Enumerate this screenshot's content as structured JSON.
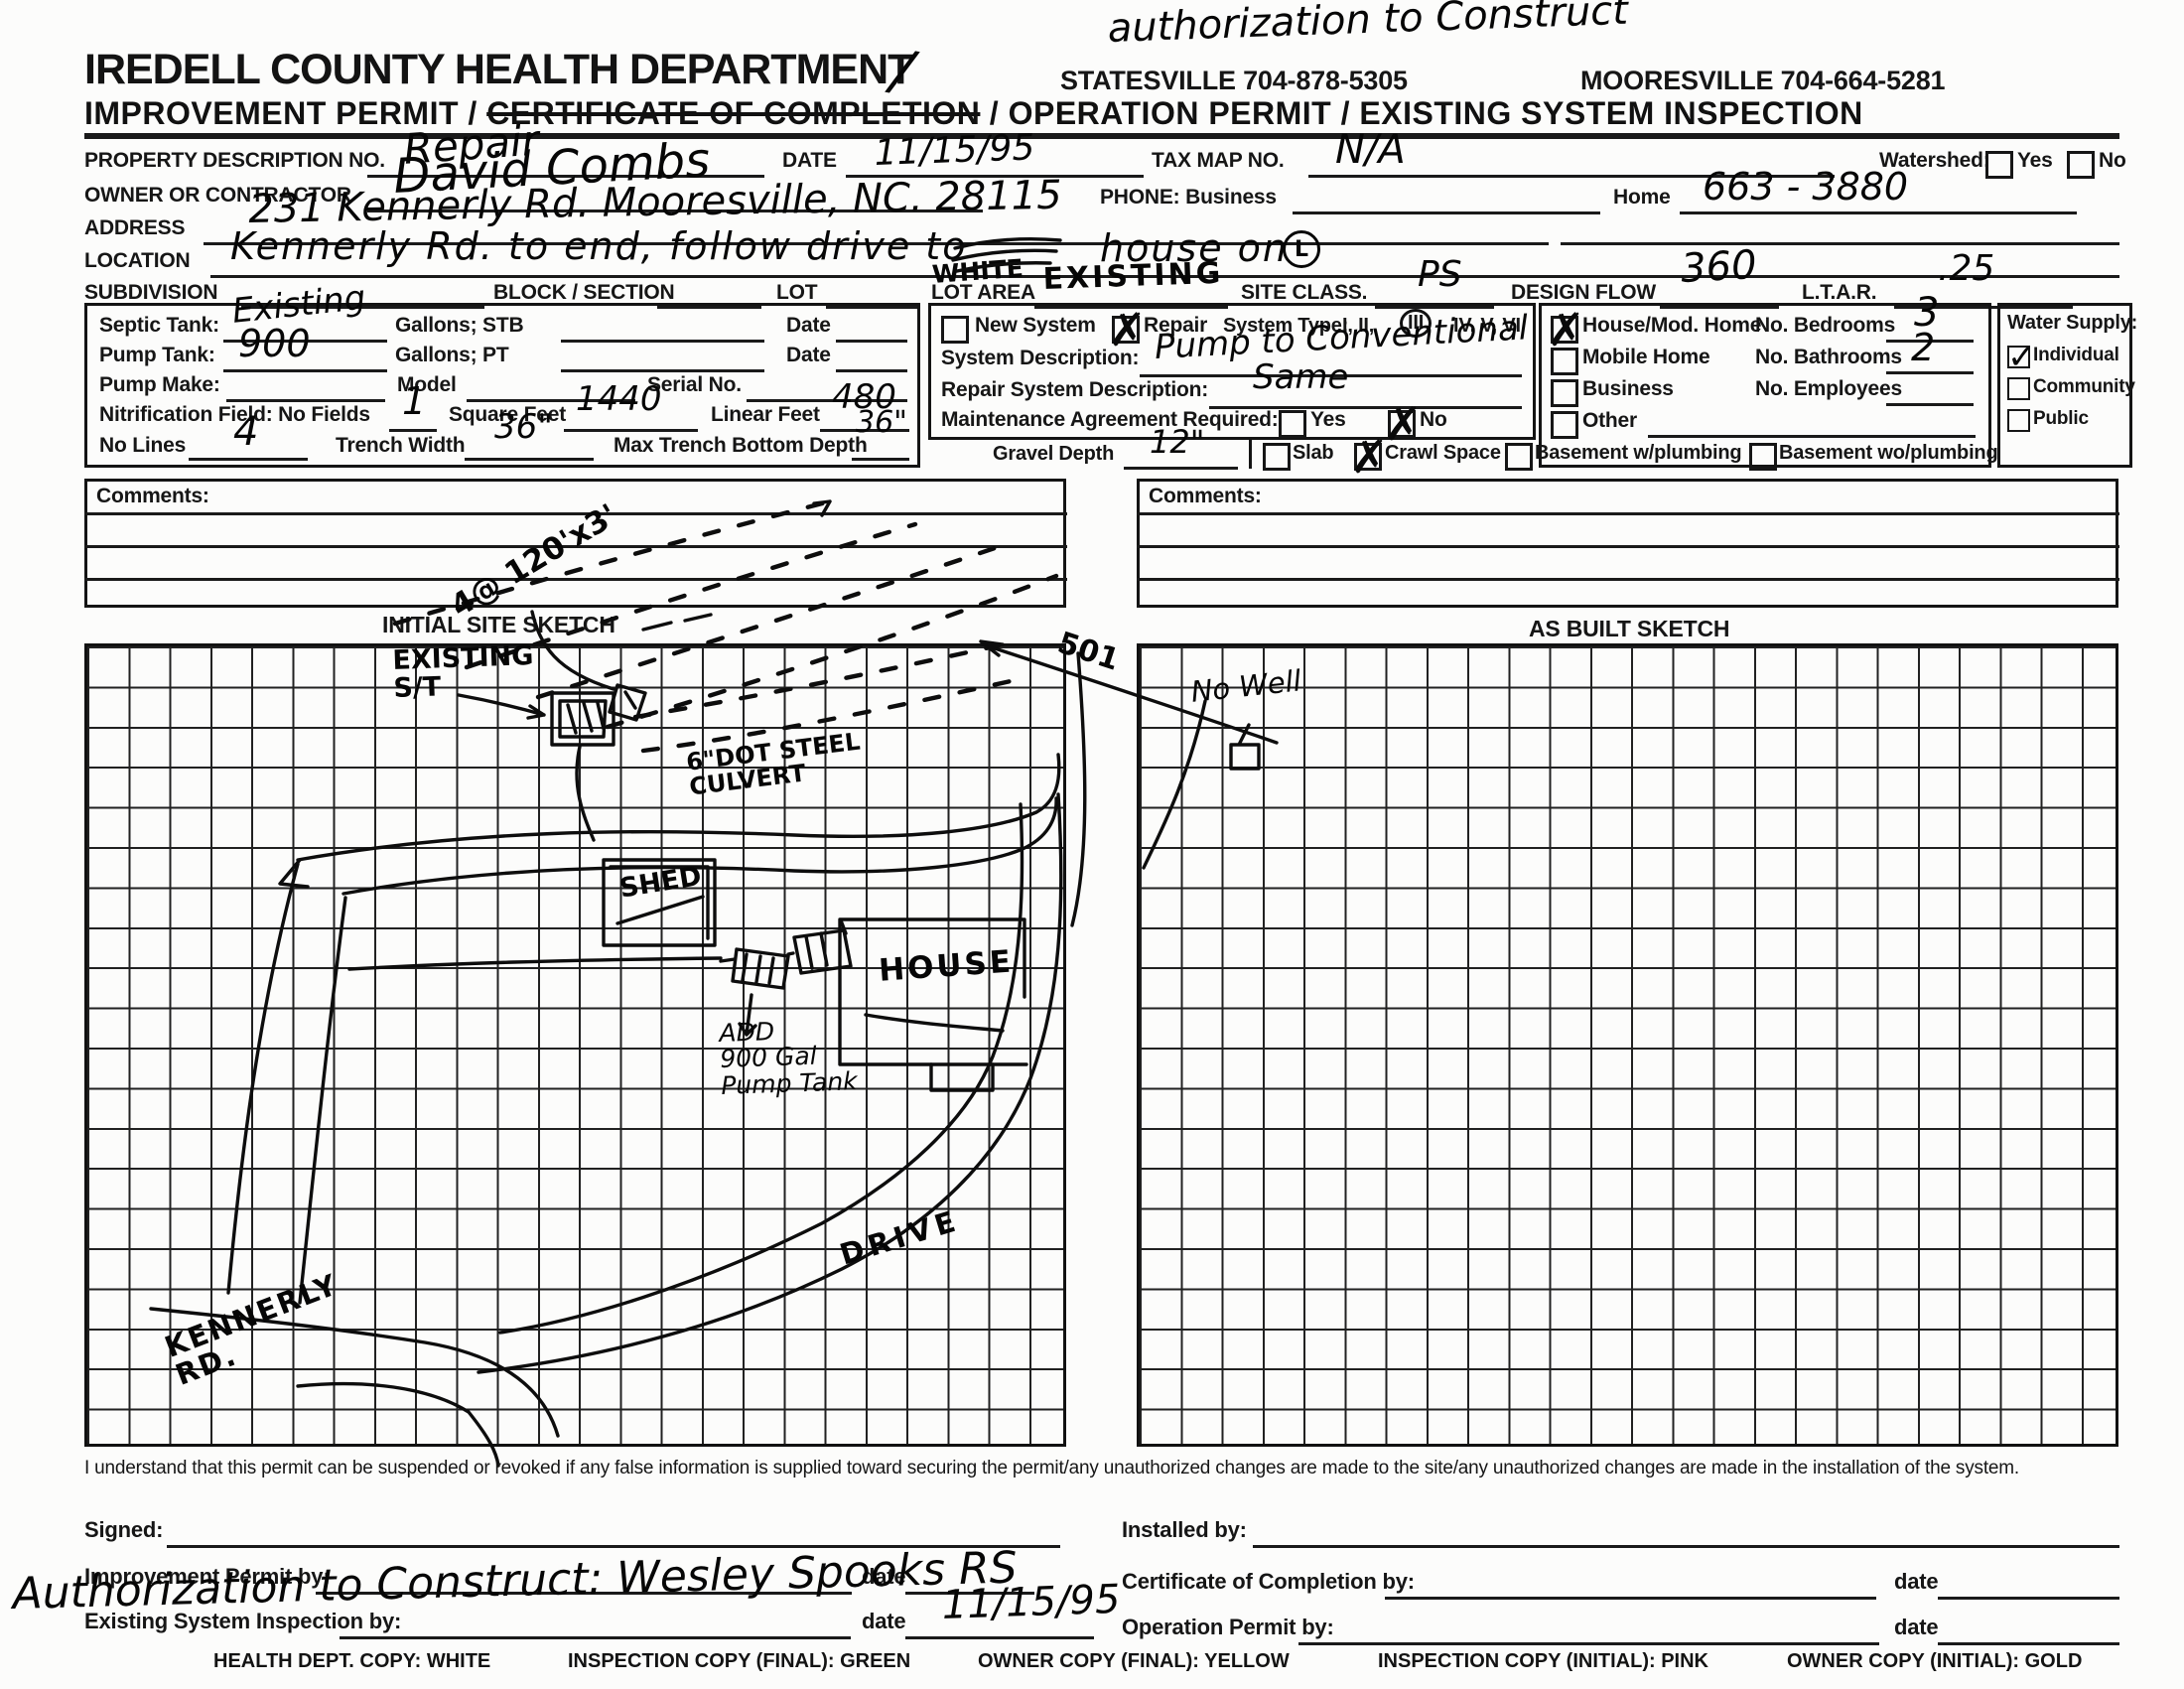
{
  "header": {
    "handwritten_note": "authorization to Construct",
    "department": "IREDELL COUNTY HEALTH DEPARTMENT",
    "slash": "/",
    "phone_statesville": "STATESVILLE 704-878-5305",
    "phone_mooresville": "MOORESVILLE 704-664-5281",
    "title_pre": "IMPROVEMENT PERMIT / ",
    "title_struck": "CERTIFICATE OF COMPLETION",
    "title_post": " / OPERATION PERMIT / EXISTING SYSTEM INSPECTION"
  },
  "fields": {
    "property_no_label": "PROPERTY DESCRIPTION NO.",
    "property_no_value": "Repair",
    "date_label": "DATE",
    "date_value": "11/15/95",
    "tax_map_label": "TAX MAP NO.",
    "tax_map_value": "N/A",
    "watershed_label": "Watershed:",
    "watershed_yes_label": "Yes",
    "watershed_no_label": "No",
    "owner_label": "OWNER OR CONTRACTOR",
    "owner_value": "David Combs",
    "phone_business_label": "PHONE: Business",
    "home_label": "Home",
    "home_value": "663 - 3880",
    "address_label": "ADDRESS",
    "address_value": "231 Kennerly Rd.        Mooresville, NC.  28115",
    "location_label": "LOCATION",
    "location_value_pre": "Kennerly Rd. to end, follow drive to",
    "location_overwrite": "WHITE",
    "location_value_post": "house on",
    "location_circle": "L",
    "subdivision_label": "SUBDIVISION",
    "block_label": "BLOCK / SECTION",
    "lot_label": "LOT",
    "lot_area_label": "LOT AREA",
    "lot_area_value": "EXISTING",
    "site_class_label": "SITE CLASS.",
    "site_class_value": "PS",
    "design_flow_label": "DESIGN FLOW",
    "design_flow_value": "360",
    "ltar_label": "L.T.A.R.",
    "ltar_value": ".25"
  },
  "tank_box": {
    "septic_label": "Septic Tank:",
    "septic_value": "Existing",
    "gallons_stb_label": "Gallons;  STB",
    "date_label": "Date",
    "pump_label": "Pump Tank:",
    "pump_value": "900",
    "gallons_pt_label": "Gallons;  PT",
    "pump_make_label": "Pump Make:",
    "model_label": "Model",
    "serial_label": "Serial No.",
    "nitrification_label": "Nitrification Field:  No Fields",
    "no_fields_value": "1",
    "square_feet_label": "Square Feet",
    "square_feet_value": "1440",
    "linear_feet_label": "Linear Feet",
    "linear_feet_value": "480",
    "no_lines_label": "No Lines",
    "no_lines_value": "4",
    "trench_width_label": "Trench Width",
    "trench_width_value": "36\"",
    "max_depth_label": "Max Trench Bottom Depth",
    "max_depth_value": "36\""
  },
  "system_box": {
    "new_system_label": "New System",
    "repair_label": "Repair",
    "system_type_label": "System Type:",
    "system_type_pre": "I, II,",
    "system_type_circled": "III",
    "system_type_post": "IV, V, VI",
    "description_label": "System Description:",
    "description_value": "Pump to Conventional",
    "repair_description_label": "Repair System Description:",
    "repair_description_value": "Same",
    "maintenance_label": "Maintenance Agreement Required:",
    "yes_label": "Yes",
    "no_label": "No"
  },
  "structure_box": {
    "house_label": "House/Mod. Home",
    "mobile_label": "Mobile Home",
    "business_label": "Business",
    "other_label": "Other",
    "bedrooms_label": "No. Bedrooms",
    "bedrooms_value": "3",
    "bathrooms_label": "No. Bathrooms",
    "bathrooms_value": "2",
    "employees_label": "No. Employees"
  },
  "water_box": {
    "label": "Water Supply:",
    "individual_label": "Individual",
    "community_label": "Community",
    "public_label": "Public"
  },
  "foundation_row": {
    "gravel_label": "Gravel Depth",
    "gravel_value": "12\"",
    "slab_label": "Slab",
    "crawl_label": "Crawl Space",
    "basement_w_label": "Basement w/plumbing",
    "basement_wo_label": "Basement wo/plumbing"
  },
  "checks": {
    "repair": true,
    "new_system": false,
    "maintenance_yes": false,
    "maintenance_no": true,
    "house_mod": true,
    "mobile_home": false,
    "business": false,
    "other": false,
    "water_individual": true,
    "water_community": false,
    "water_public": false,
    "watershed_yes": false,
    "watershed_no": false,
    "slab": false,
    "crawl_space": true,
    "basement_w": false,
    "basement_wo": false
  },
  "comments": {
    "left_label": "Comments:",
    "right_label": "Comments:"
  },
  "sketch": {
    "initial_label": "INITIAL SITE SKETCH",
    "as_built_label": "AS BUILT SKETCH",
    "annotations": {
      "field_note": "4@ 120'x3'",
      "existing_st": "EXISTING\nS/T",
      "road_501": "501",
      "no_well": "No Well",
      "culvert": "6\"DOT STEEL\n CULVERT",
      "shed": "SHED",
      "house": "HOUSE",
      "pump_tank": "ADD\n900 Gal\nPump Tank",
      "drive": "DRIVE",
      "kennerly": "KENNERLY\n RD."
    }
  },
  "statement": "I understand that this permit can be suspended or revoked if any false information is supplied toward securing the permit/any unauthorized changes are made to the site/any unauthorized changes are made in the installation of the system.",
  "signatures": {
    "signed_label": "Signed:",
    "installed_label": "Installed by:",
    "improvement_label": "Improvement Permit by:",
    "certificate_label": "Certificate of Completion by:",
    "existing_label": "Existing System Inspection by:",
    "operation_label": "Operation Permit by:",
    "date_label": "date",
    "inspection_date_value": "11/15/95",
    "authorization_note": "Authorization to Construct:  Wesley Spooks  RS"
  },
  "footer": {
    "copies": [
      "HEALTH DEPT. COPY: WHITE",
      "INSPECTION COPY (FINAL): GREEN",
      "OWNER COPY (FINAL): YELLOW",
      "INSPECTION COPY (INITIAL): PINK",
      "OWNER COPY (INITIAL): GOLD"
    ]
  }
}
